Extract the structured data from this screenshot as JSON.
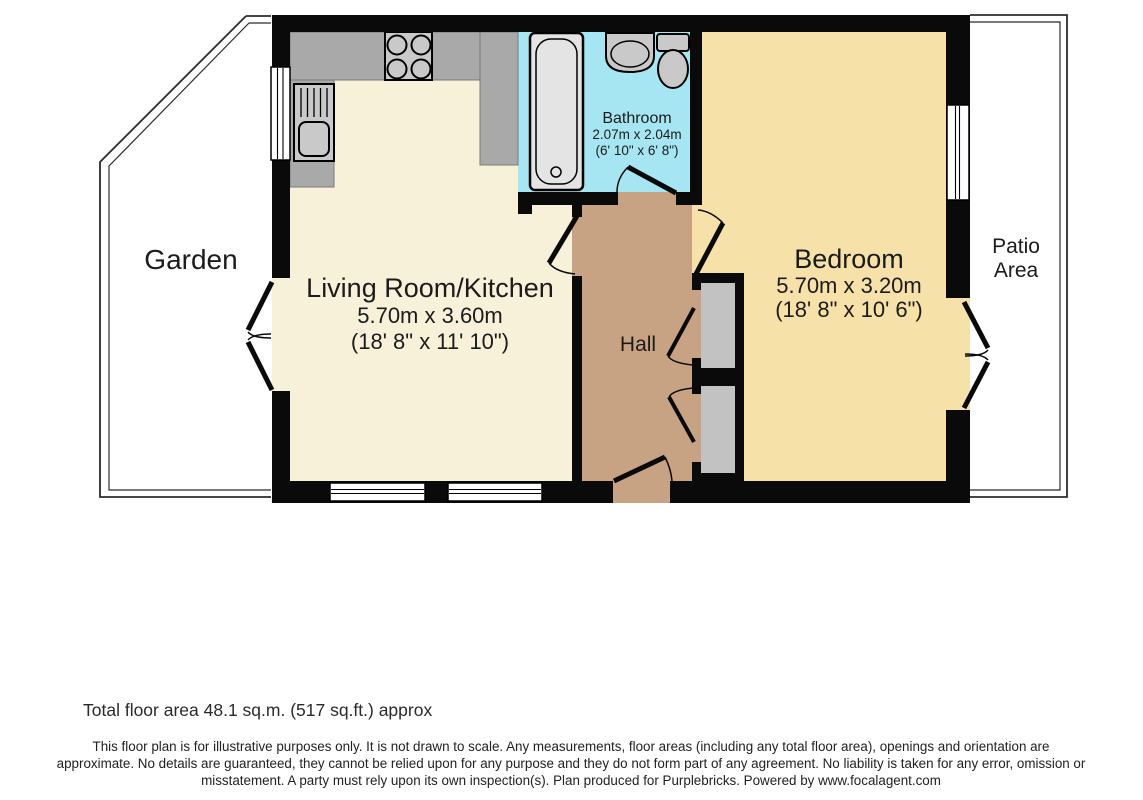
{
  "plan": {
    "garden_label": "Garden",
    "patio_label_line1": "Patio",
    "patio_label_line2": "Area",
    "rooms": {
      "living_kitchen": {
        "name": "Living Room/Kitchen",
        "metric": "5.70m x 3.60m",
        "imperial": "(18' 8\" x 11' 10\")"
      },
      "bedroom": {
        "name": "Bedroom",
        "metric": "5.70m x 3.20m",
        "imperial": "(18' 8\" x 10' 6\")"
      },
      "bathroom": {
        "name": "Bathroom",
        "metric": "2.07m x 2.04m",
        "imperial": "(6' 10\" x 6' 8\")"
      },
      "hall": {
        "name": "Hall"
      }
    }
  },
  "footer": {
    "total_area": "Total floor area 48.1 sq.m. (517 sq.ft.) approx",
    "disclaimer": "This floor plan is for illustrative purposes only. It is not drawn to scale. Any measurements, floor areas (including any total floor area), openings and orientation are approximate. No details are guaranteed, they cannot be relied upon for any purpose and they do not form part of any agreement. No liability is taken for any error, omission or misstatement. A party must rely upon its own inspection(s). Plan produced for Purplebricks. Powered by www.focalagent.com"
  },
  "colors": {
    "wall": "#0a0a0a",
    "living_floor": "#f7f1da",
    "bedroom_floor": "#f6e2a9",
    "bathroom_floor": "#a5e6f2",
    "hall_floor": "#c7a383",
    "closet_fill": "#c2c2c2",
    "counter_fill": "#a9a9a9",
    "fixture_fill": "#c9c9c9",
    "bath_fill": "#e4e4e4"
  }
}
